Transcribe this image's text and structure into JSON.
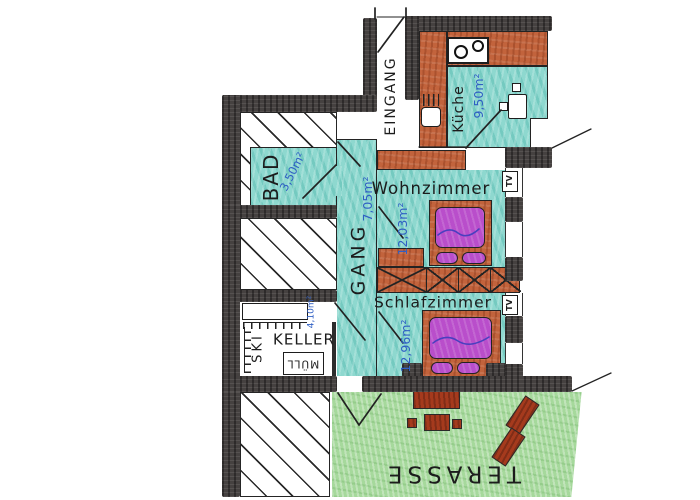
{
  "plan": {
    "rooms": {
      "eingang": {
        "label": "EINGANG"
      },
      "kueche": {
        "label": "Küche",
        "area": "9,50m²"
      },
      "bad": {
        "label": "BAD",
        "area": "3,50m²"
      },
      "gang": {
        "label": "GANG",
        "area": "7,05m²"
      },
      "wohnzimmer": {
        "label": "Wohnzimmer",
        "area": "12,03m²"
      },
      "schlafzimmer": {
        "label": "Schlafzimmer",
        "area": "12,96m²"
      },
      "keller": {
        "label": "KELLER",
        "area": "4,10m²"
      },
      "terrasse": {
        "label": "TERASSE"
      }
    },
    "fixtures": {
      "ski_rack": {
        "label": "SKI"
      },
      "muell_bin": {
        "label": "MÜLL"
      },
      "tv_wohnzimmer": {
        "label": "TV"
      },
      "tv_schlafzimmer": {
        "label": "TV"
      }
    },
    "colors": {
      "floor_teal": "#8ed8cf",
      "furniture_orange": "#c2633c",
      "bed_purple": "#b94ecb",
      "terrace_green": "#a6d99c",
      "wall_dark": "#454140",
      "annotation_blue": "#2f5fc4",
      "terrace_furniture_red": "#a53a1d"
    }
  }
}
